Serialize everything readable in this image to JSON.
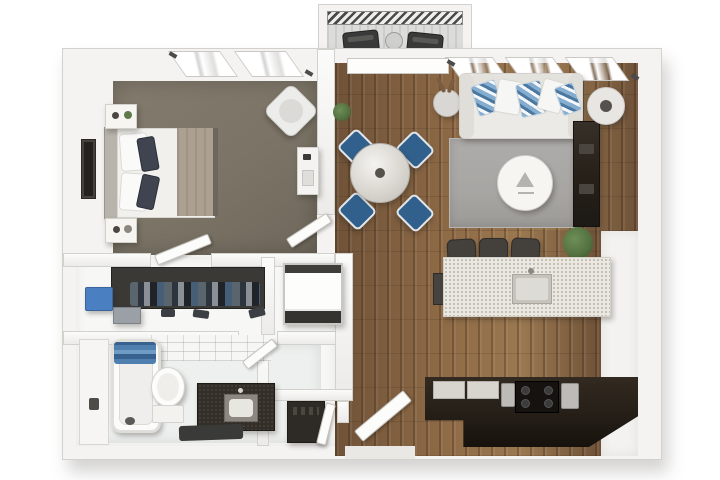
{
  "scene": {
    "kind": "3d-floorplan-render",
    "description": "Top-down 3D rendered floor plan of a one-bedroom apartment with balcony",
    "visible_text": ""
  },
  "palette": {
    "bg": "#ffffff",
    "wall": "#f4f3f1",
    "wall_edge": "#d3d1cd",
    "bedroom_floor": "#7b7466",
    "wood": "#8e6a46",
    "wood_dark": "#6f5238",
    "rug": "#a8a6a3",
    "sofa": "#eceae6",
    "pillow_blue": "#85add0",
    "chair_blue": "#31608c",
    "table_glass": "#d9d6d0",
    "island": "#ebe8e2",
    "speckle": "#b7b2a7",
    "stool": "#44403c",
    "counter_dark": "#272119",
    "stove": "#151210",
    "closet_dark": "#3a3936",
    "bin_blue": "#4a7fc1",
    "towel_blue": "#4a7ca8",
    "vanity_dark": "#332e28",
    "plant": "#53703f",
    "balcony_floor": "#dcdcda",
    "metal": "#bcbbb8",
    "bedding": "#f1f0ed",
    "blanket": "#aca191",
    "accent_dark": "#3f4450"
  },
  "rooms": {
    "bedroom": {
      "label": "bedroom",
      "items": [
        "bed",
        "white-pillows",
        "dark-accent-pillows",
        "tan-blanket",
        "nightstand-north",
        "nightstand-south",
        "accent-chair",
        "desk",
        "wall-art",
        "two-windows"
      ]
    },
    "closet": {
      "label": "walk-in closet",
      "items": [
        "hanging-clothes-rod",
        "blue-storage-bin",
        "gray-box",
        "shoes"
      ]
    },
    "shower": {
      "label": "shower niche",
      "items": [
        "glass-framed-shower-cube"
      ]
    },
    "bathroom": {
      "label": "bathroom",
      "items": [
        "bathtub",
        "blue-towels",
        "toilet",
        "dark-vanity-with-sink",
        "bath-mat",
        "tiled-wall",
        "side-counter"
      ]
    },
    "living": {
      "label": "living room",
      "items": [
        "white-sofa",
        "blue-white-throw-pillows",
        "gray-area-rug",
        "round-coffee-table",
        "dark-media-console",
        "side-table-with-lamp",
        "floor-plant",
        "decor-sculpture",
        "three-windows"
      ]
    },
    "dining": {
      "label": "dining area",
      "items": [
        "round-glass-table",
        "blue-chair-x4",
        "potted-plant"
      ]
    },
    "kitchen": {
      "label": "kitchen",
      "items": [
        "speckled-island-with-sink",
        "bar-stool-x3",
        "dark-l-counter",
        "black-range",
        "cookware"
      ]
    },
    "entry": {
      "label": "entry",
      "items": [
        "open-entry-door",
        "utility-closet",
        "dark-appliance"
      ]
    },
    "balcony": {
      "label": "balcony",
      "items": [
        "railing",
        "lounge-chair-x2",
        "bistro-table",
        "sliding-door"
      ]
    }
  }
}
